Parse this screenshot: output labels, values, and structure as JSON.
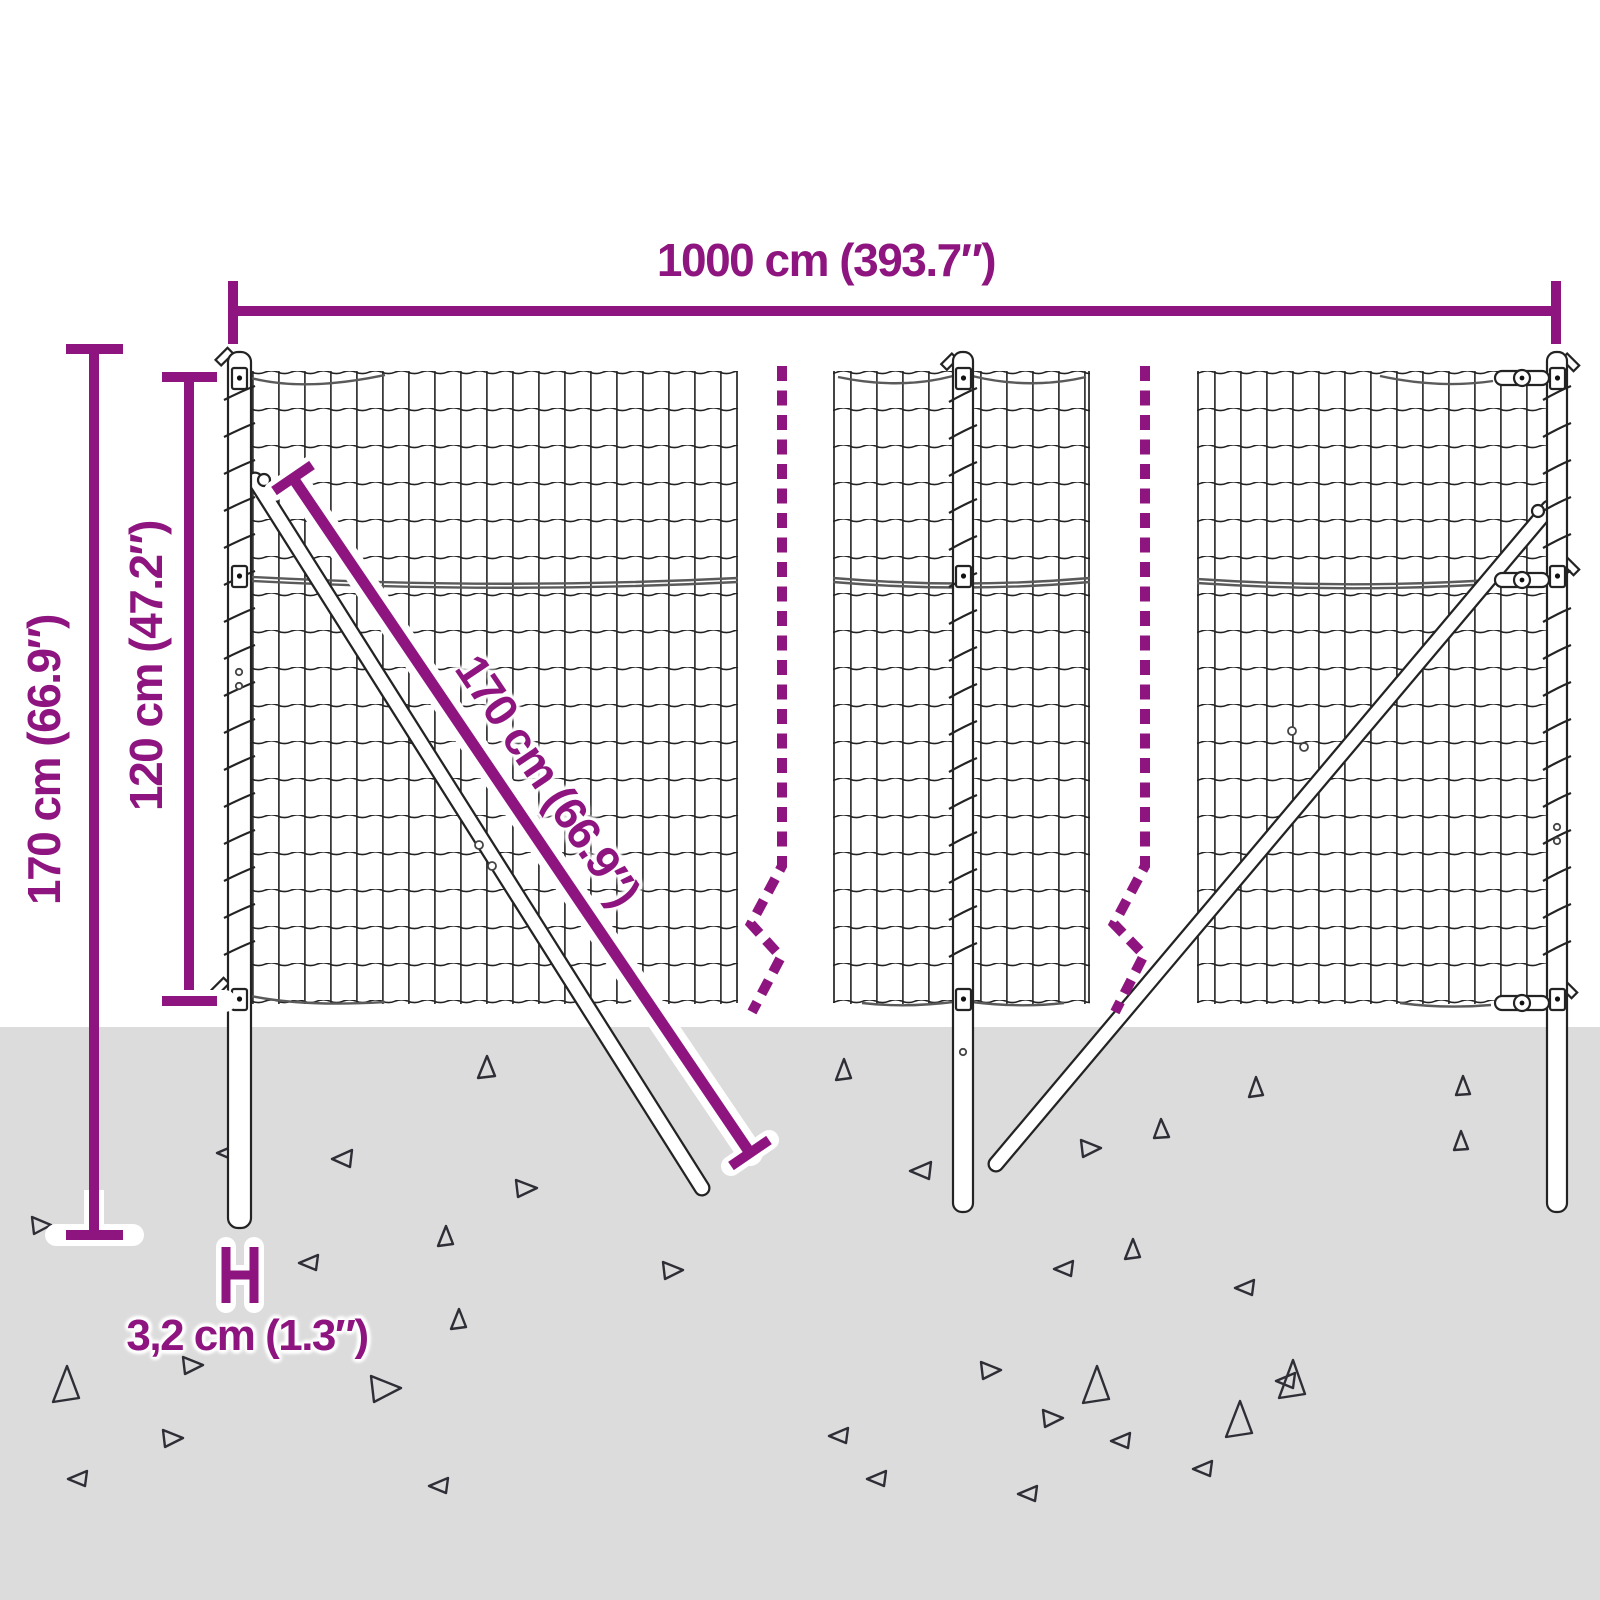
{
  "title": "Wire mesh fence dimension diagram",
  "colors": {
    "accent": "#8E157F",
    "ground": "#DCDCDC",
    "line": "#232323"
  },
  "dimensions": {
    "total_width": "1000 cm (393.7″)",
    "total_height": "170 cm (66.9″)",
    "mesh_height": "120 cm (47.2″)",
    "brace_length": "170 cm (66.9″)",
    "post_diameter": "3,2 cm (1.3″)"
  }
}
